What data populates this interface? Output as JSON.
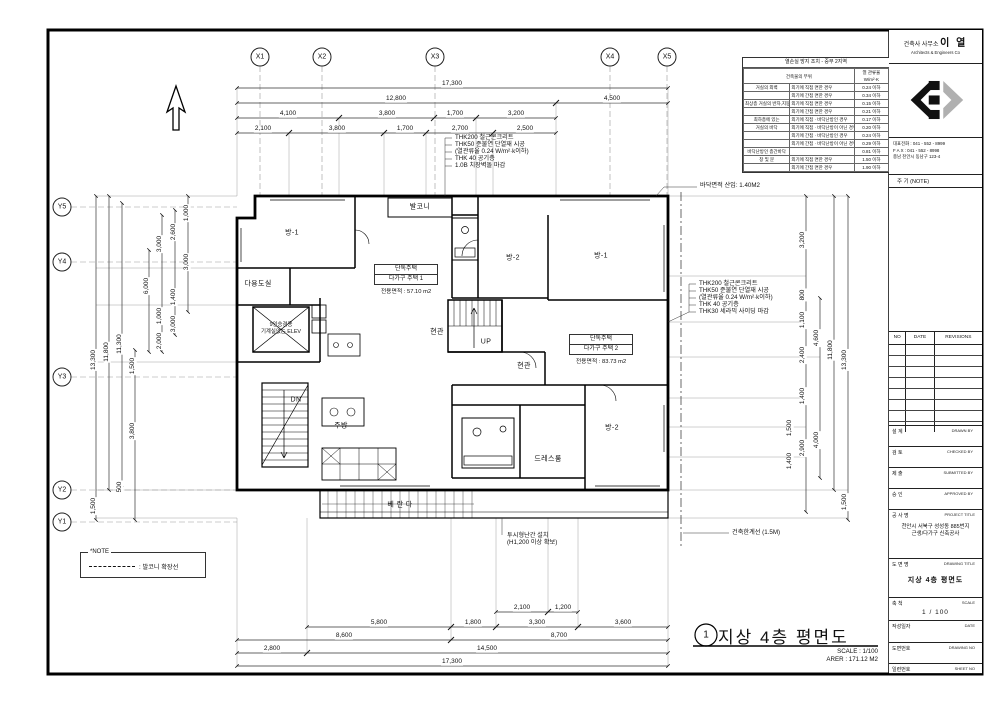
{
  "grid": {
    "top": [
      {
        "t": "X1",
        "x": 260,
        "y": 57
      },
      {
        "t": "X2",
        "x": 322,
        "y": 57
      },
      {
        "t": "X3",
        "x": 435,
        "y": 57
      },
      {
        "t": "X4",
        "x": 610,
        "y": 57
      },
      {
        "t": "X5",
        "x": 667,
        "y": 57
      }
    ],
    "left": [
      {
        "t": "Y5",
        "x": 62,
        "y": 207
      },
      {
        "t": "Y4",
        "x": 62,
        "y": 262
      },
      {
        "t": "Y3",
        "x": 62,
        "y": 377
      },
      {
        "t": "Y2",
        "x": 62,
        "y": 490
      },
      {
        "t": "Y1",
        "x": 62,
        "y": 522
      }
    ]
  },
  "dims": {
    "top": [
      {
        "t": "17,300",
        "x": 452,
        "y": 84
      },
      {
        "t": "12,800",
        "x": 396,
        "y": 99
      },
      {
        "t": "4,500",
        "x": 612,
        "y": 99
      },
      {
        "t": "4,100",
        "x": 288,
        "y": 114
      },
      {
        "t": "3,800",
        "x": 387,
        "y": 114
      },
      {
        "t": "1,700",
        "x": 455,
        "y": 114
      },
      {
        "t": "3,200",
        "x": 516,
        "y": 114
      },
      {
        "t": "2,100",
        "x": 263,
        "y": 129
      },
      {
        "t": "3,800",
        "x": 337,
        "y": 129
      },
      {
        "t": "1,700",
        "x": 405,
        "y": 129
      },
      {
        "t": "2,700",
        "x": 460,
        "y": 129
      },
      {
        "t": "2,500",
        "x": 525,
        "y": 129
      }
    ],
    "bottom": [
      {
        "t": "2,100",
        "x": 522,
        "y": 608
      },
      {
        "t": "1,200",
        "x": 563,
        "y": 608
      },
      {
        "t": "5,800",
        "x": 379,
        "y": 623
      },
      {
        "t": "1,800",
        "x": 473,
        "y": 623
      },
      {
        "t": "3,300",
        "x": 537,
        "y": 623
      },
      {
        "t": "3,600",
        "x": 623,
        "y": 623
      },
      {
        "t": "8,600",
        "x": 344,
        "y": 636
      },
      {
        "t": "8,700",
        "x": 559,
        "y": 636
      },
      {
        "t": "2,800",
        "x": 272,
        "y": 649
      },
      {
        "t": "14,500",
        "x": 487,
        "y": 649
      },
      {
        "t": "17,300",
        "x": 452,
        "y": 662
      }
    ],
    "left": [
      {
        "t": "1,000",
        "x": 187,
        "y": 213,
        "rot": -90
      },
      {
        "t": "2,600",
        "x": 174,
        "y": 232,
        "rot": -90
      },
      {
        "t": "3,000",
        "x": 160,
        "y": 244,
        "rot": -90
      },
      {
        "t": "3,000",
        "x": 187,
        "y": 262,
        "rot": -90
      },
      {
        "t": "6,000",
        "x": 147,
        "y": 286,
        "rot": -90
      },
      {
        "t": "1,400",
        "x": 174,
        "y": 297,
        "rot": -90
      },
      {
        "t": "1,000",
        "x": 160,
        "y": 316,
        "rot": -90
      },
      {
        "t": "3,000",
        "x": 174,
        "y": 324,
        "rot": -90
      },
      {
        "t": "2,000",
        "x": 160,
        "y": 341,
        "rot": -90
      },
      {
        "t": "11,300",
        "x": 120,
        "y": 344,
        "rot": -90
      },
      {
        "t": "11,800",
        "x": 107,
        "y": 352,
        "rot": -90
      },
      {
        "t": "13,300",
        "x": 94,
        "y": 360,
        "rot": -90
      },
      {
        "t": "1,500",
        "x": 133,
        "y": 366,
        "rot": -90
      },
      {
        "t": "3,800",
        "x": 133,
        "y": 431,
        "rot": -90
      },
      {
        "t": "500",
        "x": 120,
        "y": 487,
        "rot": -90
      },
      {
        "t": "1,500",
        "x": 94,
        "y": 506,
        "rot": -90
      }
    ],
    "right": [
      {
        "t": "3,200",
        "x": 803,
        "y": 240,
        "rot": -90
      },
      {
        "t": "800",
        "x": 803,
        "y": 295,
        "rot": -90
      },
      {
        "t": "1,100",
        "x": 803,
        "y": 320,
        "rot": -90
      },
      {
        "t": "2,400",
        "x": 803,
        "y": 355,
        "rot": -90
      },
      {
        "t": "4,600",
        "x": 817,
        "y": 338,
        "rot": -90
      },
      {
        "t": "11,800",
        "x": 831,
        "y": 350,
        "rot": -90
      },
      {
        "t": "13,300",
        "x": 845,
        "y": 360,
        "rot": -90
      },
      {
        "t": "1,400",
        "x": 803,
        "y": 396,
        "rot": -90
      },
      {
        "t": "1,500",
        "x": 790,
        "y": 428,
        "rot": -90
      },
      {
        "t": "2,900",
        "x": 803,
        "y": 448,
        "rot": -90
      },
      {
        "t": "1,400",
        "x": 790,
        "y": 461,
        "rot": -90
      },
      {
        "t": "4,000",
        "x": 817,
        "y": 440,
        "rot": -90
      },
      {
        "t": "1,500",
        "x": 845,
        "y": 502,
        "rot": -90
      }
    ]
  },
  "rooms": [
    {
      "t": "방-1",
      "x": 292,
      "y": 233
    },
    {
      "t": "발코니",
      "x": 420,
      "y": 207
    },
    {
      "t": "방-2",
      "x": 513,
      "y": 258
    },
    {
      "t": "방-1",
      "x": 601,
      "y": 256
    },
    {
      "t": "다용도실",
      "x": 258,
      "y": 284
    },
    {
      "t": "현관",
      "x": 437,
      "y": 332
    },
    {
      "t": "현관",
      "x": 524,
      "y": 366
    },
    {
      "t": "주방",
      "x": 341,
      "y": 426
    },
    {
      "t": "드레스룸",
      "x": 548,
      "y": 459
    },
    {
      "t": "방-2",
      "x": 612,
      "y": 428
    },
    {
      "t": "베 란 다",
      "x": 400,
      "y": 505
    },
    {
      "t": "UP",
      "x": 486,
      "y": 342
    },
    {
      "t": "DN",
      "x": 296,
      "y": 400
    }
  ],
  "unit1": {
    "line1": "단독주택",
    "line2": "다가구 주택 1",
    "area": "전용면적 : 57.10 m2"
  },
  "unit2": {
    "line1": "단독주택",
    "line2": "다가구 주택 2",
    "area": "전용면적 : 83.73 m2"
  },
  "elevator": {
    "line1": "9인승겸용",
    "line2": "기계실없는 ELEV"
  },
  "notes": {
    "wall_left": [
      "THK200 철근콘크리트",
      "THK50 준불연 단열재 시공",
      "(열관류율 0.24  W/m²·k이하)",
      "THK 40 공기층",
      "1.0B 치장벽돌 마감"
    ],
    "wall_right": [
      "THK200 철근콘크리트",
      "THK50 준불연 단열재 시공",
      "(열관류율 0.24  W/m²·k이하)",
      "THK 40 공기층",
      "THK30 세라믹 사이딩 마감"
    ],
    "floor_area": "바닥면적 산입: 1.40M2",
    "railing": [
      "투시형난간 설치",
      "(H1,200 이상 확보)"
    ],
    "boundary": "건축한계선 (1.5M)",
    "legend_title": "*NOTE",
    "legend_text": ": 발코니 확장선"
  },
  "insulation_table": {
    "title": "열손실 방지 조치 - 중부 2지역",
    "header": {
      "part": "건축물의 부위",
      "u1": "열 관류율",
      "u2": "W/m²·K"
    },
    "rows": [
      {
        "part": "거실의 외벽",
        "cond": "외기에 직접 면한 경우",
        "val": "0.24 이하"
      },
      {
        "part": "",
        "cond": "외기에 간접 면한 경우",
        "val": "0.34 이하"
      },
      {
        "part": "최상층 거실의 반자,지붕",
        "cond": "외기에 직접 면한 경우",
        "val": "0.15 이하"
      },
      {
        "part": "",
        "cond": "외기에 간접 면한 경우",
        "val": "0.21 이하"
      },
      {
        "part": "최하층에 있는",
        "cond": "외기에 직접 · 바닥난방인 경우",
        "val": "0.17 이하"
      },
      {
        "part": "거실의 바닥",
        "cond": "외기에 직접 · 바닥난방이 아닌 경우",
        "val": "0.20 이하"
      },
      {
        "part": "",
        "cond": "외기에 간접 · 바닥난방인 경우",
        "val": "0.24 이하"
      },
      {
        "part": "",
        "cond": "외기에 간접 · 바닥난방이 아닌 경우",
        "val": "0.29 이하"
      },
      {
        "part": "바닥난방인 층간바닥",
        "cond": "",
        "val": "0.81 이하"
      },
      {
        "part": "창 및 문",
        "cond": "외기에 직접 면한 경우",
        "val": "1.50 이하"
      },
      {
        "part": "",
        "cond": "외기에 간접 면한 경우",
        "val": "1.90 이하"
      }
    ]
  },
  "titleblock": {
    "firm": {
      "prefix": "건축사 사무소",
      "name": "이 열",
      "sub": "Architects  &  Engineers  Co",
      "tel": "대표전화 : 041 - 552 - 8999",
      "fax": "F A X : 041 - 552 - 8998",
      "addr": "충남 천안시 동남구 123-4"
    },
    "note_header": "주  기 (NOTE)",
    "revisions": {
      "no": "NO",
      "date": "DATE",
      "label": "REVISIONS"
    },
    "sign_rows": [
      {
        "kr": "설 계",
        "en": "DRAWN  BY"
      },
      {
        "kr": "검 토",
        "en": "CHECKED  BY"
      },
      {
        "kr": "제 출",
        "en": "SUBMITTED BY"
      },
      {
        "kr": "승 인",
        "en": "APPROVED BY"
      }
    ],
    "project": {
      "kr": "공 사 명",
      "en": "PROJECT TITLE",
      "line1": "천안시 서북구 성성동 885번지",
      "line2": "근생/다가구 신축공사"
    },
    "drawing": {
      "kr": "도 면 명",
      "en": "DRAWING TITLE",
      "title": "지상 4층 평면도"
    },
    "scale": {
      "kr": "축  척",
      "en": "SCALE",
      "value": "1 / 100"
    },
    "date": {
      "kr": "작성일자",
      "en": "DATE"
    },
    "dwg_no": {
      "kr": "도면번호",
      "en": "DRAWING NO"
    },
    "sheet_no": {
      "kr": "일련번호",
      "en": "SHEET NO"
    }
  },
  "footer": {
    "num": "1",
    "title": "지상 4층 평면도",
    "scale": "SCALE : 1/100",
    "area": "ARER : 171.12 M2"
  }
}
